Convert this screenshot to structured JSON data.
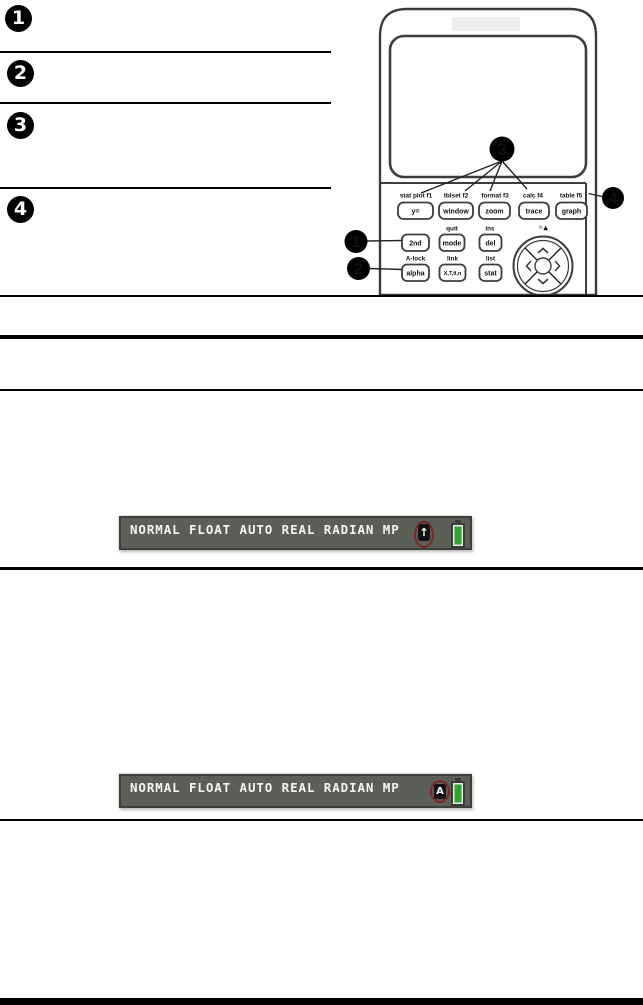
{
  "legend": {
    "items": [
      {
        "num": "1"
      },
      {
        "num": "2"
      },
      {
        "num": "3"
      },
      {
        "num": "4"
      }
    ]
  },
  "calculator": {
    "callout1": "1",
    "callout2": "2",
    "callout3": "3",
    "callout4": "4",
    "row1": [
      {
        "label": "stat plot f1",
        "key": "y="
      },
      {
        "label": "tblset f2",
        "key": "window"
      },
      {
        "label": "format f3",
        "key": "zoom"
      },
      {
        "label": "calc f4",
        "key": "trace"
      },
      {
        "label": "table f5",
        "key": "graph"
      }
    ],
    "row2": [
      {
        "label": "",
        "key": "2nd"
      },
      {
        "label": "quit",
        "key": "mode"
      },
      {
        "label": "ins",
        "key": "del"
      }
    ],
    "row3": [
      {
        "label": "A-lock",
        "key": "alpha"
      },
      {
        "label": "link",
        "key": "X,T,θ,n"
      },
      {
        "label": "list",
        "key": "stat"
      }
    ],
    "brightness": "☼▲"
  },
  "status_bar_1": {
    "text": "NORMAL FLOAT AUTO REAL RADIAN MP",
    "indicator": "↑"
  },
  "status_bar_2": {
    "text": "NORMAL FLOAT AUTO REAL RADIAN MP",
    "indicator": "A"
  },
  "colors": {
    "status_bg": "#5c5f57",
    "status_border": "#3c3f39",
    "battery_green": "#2fa42f",
    "highlight_red": "#7c2428"
  }
}
